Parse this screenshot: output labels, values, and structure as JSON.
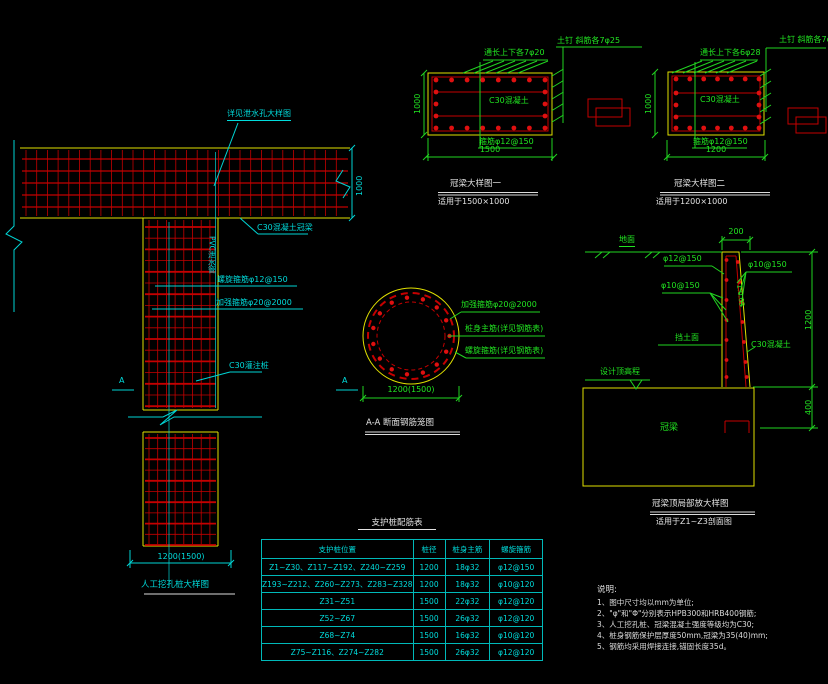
{
  "pile_detail": {
    "callout_weep": "详见泄水孔大样图",
    "dim_beam_height": "1000",
    "label_pvc": "PVC泄水管",
    "label_crown": "C30混凝土冠梁",
    "label_spiral": "螺旋箍筋φ12@150",
    "label_strength_hoop": "加强箍筋φ20@2000",
    "label_pile_concrete": "C30灌注桩",
    "section_marker": "A",
    "dim_width": "1200(1500)",
    "title": "人工挖孔桩大样图"
  },
  "crown_beam_1": {
    "label_top_bars": "通长上下各7φ20",
    "label_side": "土钉 斜筋各7φ25",
    "label_concrete": "C30混凝土",
    "label_stirrup": "箍筋φ12@150",
    "dim_width": "1500",
    "dim_height": "1000",
    "title": "冠梁大样图一",
    "subtitle": "适用于1500×1000"
  },
  "crown_beam_2": {
    "label_top_bars": "通长上下各6φ28",
    "label_side": "土钉 斜筋各7φ25",
    "label_concrete": "C30混凝土",
    "label_stirrup": "箍筋φ12@150",
    "dim_width": "1200",
    "dim_height": "1000",
    "title": "冠梁大样图二",
    "subtitle": "适用于1200×1000"
  },
  "section_aa": {
    "label_strength_hoop": "加强箍筋φ20@2000",
    "label_main_bars": "桩身主筋(详见钢筋表)",
    "label_spiral": "螺旋箍筋(详见钢筋表)",
    "dim_width": "1200(1500)",
    "title": "A-A 断面钢筋笼图"
  },
  "wall_detail": {
    "label_ground": "地面",
    "dim_top": "200",
    "label_bar_12_150": "φ12@150",
    "label_bar_10_150_right": "φ10@150",
    "label_bar_10_150_left": "φ10@150",
    "label_slope": "1:0.03",
    "label_face": "挡土面",
    "label_concrete": "C30混凝土",
    "label_elevation": "设计顶高程",
    "label_beam": "冠梁",
    "dim_height": "1200",
    "dim_embed": "400",
    "title": "冠梁顶局部放大样图",
    "subtitle": "适用于Z1~Z3剖面图"
  },
  "table": {
    "title": "支护桩配筋表",
    "headers": [
      "支护桩位置",
      "桩径",
      "桩身主筋",
      "螺旋箍筋"
    ],
    "rows": [
      [
        "Z1~Z30、Z117~Z192、Z240~Z259",
        "1200",
        "18φ32",
        "φ12@150"
      ],
      [
        "Z193~Z212、Z260~Z273、Z283~Z328",
        "1200",
        "18φ32",
        "φ10@120"
      ],
      [
        "Z31~Z51",
        "1500",
        "22φ32",
        "φ12@120"
      ],
      [
        "Z52~Z67",
        "1500",
        "26φ32",
        "φ12@120"
      ],
      [
        "Z68~Z74",
        "1500",
        "16φ32",
        "φ10@120"
      ],
      [
        "Z75~Z116、Z274~Z282",
        "1500",
        "26φ32",
        "φ12@120"
      ]
    ]
  },
  "notes": {
    "heading": "说明:",
    "items": [
      "1、图中尺寸均以mm为单位;",
      "2、\"φ\"和\"Φ\"分别表示HPB300和HRB400钢筋;",
      "3、人工挖孔桩、冠梁混凝土强度等级均为C30;",
      "4、桩身钢筋保护层厚度50mm,冠梁为35(40)mm;",
      "5、钢筋均采用焊接连接,锚固长度35d。"
    ]
  },
  "colors": {
    "background": "#000000",
    "concrete_outline_yellow": "#e0e000",
    "rebar_red": "#c40000",
    "annotation_cyan": "#00dcdc",
    "annotation_green": "#21e421",
    "text_white": "#e2e2e2"
  }
}
